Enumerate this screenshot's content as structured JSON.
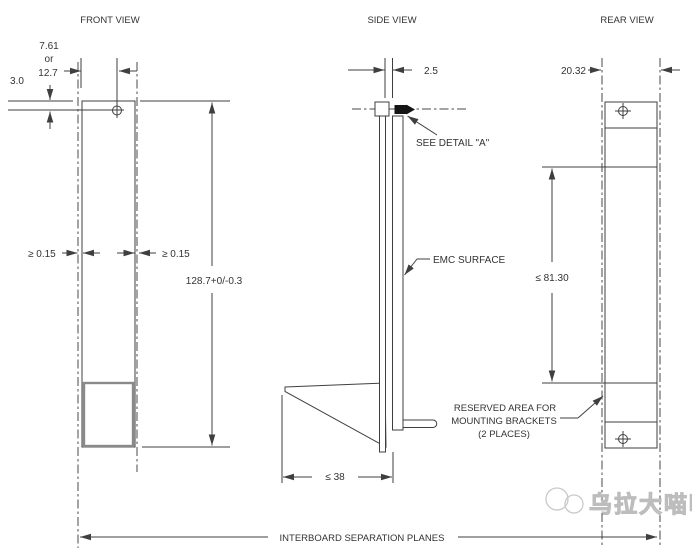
{
  "front": {
    "title": "FRONT VIEW",
    "offset_alt": "7.61",
    "or_label": "or",
    "offset": "12.7",
    "recess": "3.0",
    "gap_left": "≥  0.15",
    "gap_right": "≥  0.15",
    "board_height": "128.7+0/-0.3"
  },
  "side": {
    "title": "SIDE VIEW",
    "thickness": "2.5",
    "see_detail": "SEE DETAIL \"A\"",
    "emc_surface": "EMC SURFACE",
    "bracket_depth": "≤  38"
  },
  "rear": {
    "title": "REAR VIEW",
    "pitch": "20.32",
    "emc_height": "≤  81.30",
    "reserved1": "RESERVED AREA FOR",
    "reserved2": "MOUNTING BRACKETS",
    "reserved3": "(2 PLACES)"
  },
  "footer": {
    "interboard": "INTERBOARD SEPARATION PLANES"
  },
  "watermark": {
    "text": "乌拉大喵喵"
  },
  "colors": {
    "line": "#3f3f3f",
    "bracket_outline": "#8a8a8a",
    "detail_fill": "#151515",
    "watermark": "#bdbdbd"
  }
}
